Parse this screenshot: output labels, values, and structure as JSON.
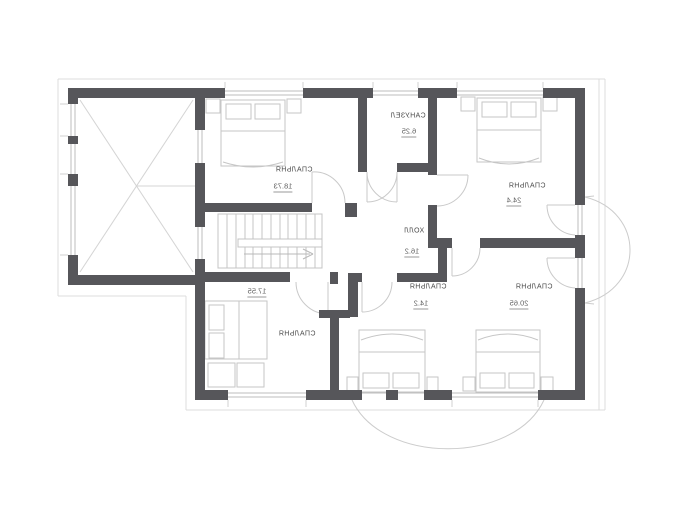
{
  "drawing": {
    "type": "architectural floor plan (second storey), text rendered mirrored",
    "colors": {
      "wall": "#56565a",
      "furniture_line": "#c6c6c6",
      "window_line": "#bdbdbd",
      "eave_line": "#dcdcdc",
      "text": "#4a4a4a"
    }
  },
  "rooms": {
    "top_left_bedroom": {
      "label": "СПАЛЬНЯ",
      "area": "18.73"
    },
    "bathroom": {
      "label": "САНУЗЕЛ",
      "area": "6.25"
    },
    "top_right_bedroom": {
      "label": "СПАЛЬНЯ",
      "area": "24.4"
    },
    "hall": {
      "label": "ХОЛЛ",
      "area": "16.2"
    },
    "bottom_left_bedroom": {
      "label": "СПАЛЬНЯ",
      "area": "17.55"
    },
    "bottom_middle_bedroom": {
      "label": "СПАЛЬНЯ",
      "area": "14.2"
    },
    "bottom_right_bedroom": {
      "label": "СПАЛЬНЯ",
      "area": "20.65"
    }
  }
}
